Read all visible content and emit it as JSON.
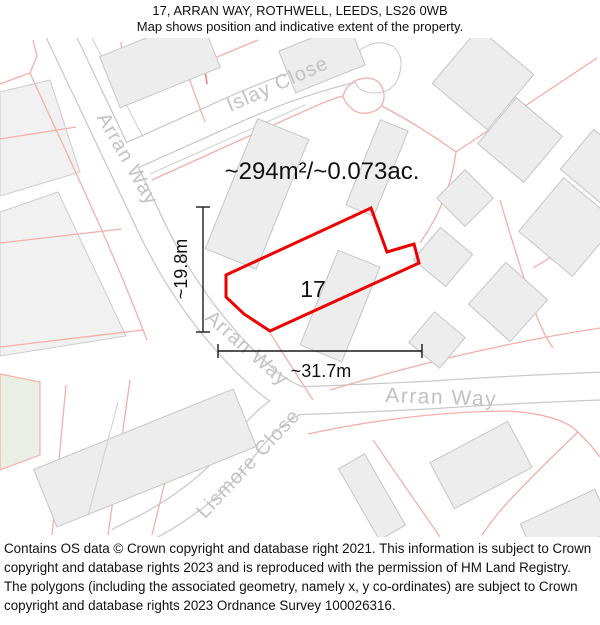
{
  "header": {
    "title_line1": "17, ARRAN WAY, ROTHWELL, LEEDS, LS26 0WB",
    "title_line2": "Map shows position and indicative extent of the property."
  },
  "map": {
    "area_label": "~294m²/~0.073ac.",
    "plot_number": "17",
    "dimensions": {
      "height_label": "~19.8m",
      "width_label": "~31.7m"
    },
    "street_labels": {
      "arran_way_upper": "Arran Way",
      "arran_way_lower": "Arran Way",
      "arran_way_east": "Arran Way",
      "islay_close": "Islay Close",
      "lismore_close": "Lismore Close"
    },
    "colors": {
      "property_outline": "#ee0000",
      "parcel_line": "#f4afa8",
      "road_edge": "#c9c9c9",
      "building_fill": "#ededed",
      "street_label": "#c2c2c2"
    }
  },
  "footer": {
    "text": "Contains OS data © Crown copyright and database right 2021. This information is subject to Crown copyright and database rights 2023 and is reproduced with the permission of HM Land Registry. The polygons (including the associated geometry, namely x, y co-ordinates) are subject to Crown copyright and database rights 2023 Ordnance Survey 100026316."
  }
}
